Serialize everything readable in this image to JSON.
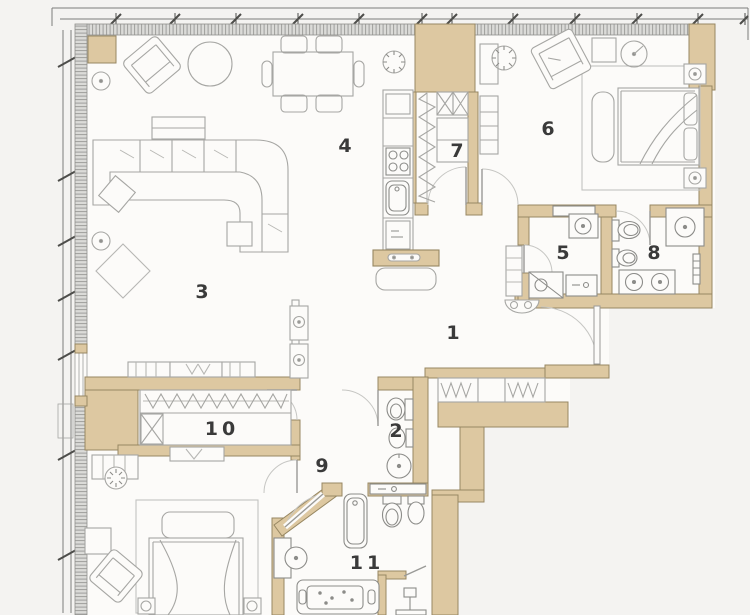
{
  "plan": {
    "rooms": [
      {
        "number": "1"
      },
      {
        "number": "2"
      },
      {
        "number": "3"
      },
      {
        "number": "4"
      },
      {
        "number": "5"
      },
      {
        "number": "6"
      },
      {
        "number": "7"
      },
      {
        "number": "8"
      },
      {
        "number": "9"
      },
      {
        "number": "10"
      },
      {
        "number": "11"
      }
    ],
    "colors": {
      "wall_fill": "#ddc8a1",
      "wall_stroke": "#978762",
      "glazing_bg": "#dbdbd8",
      "glazing_line": "#9e9e9b",
      "furniture_line": "#a6a6a3",
      "fixture_line": "#8c8c89",
      "door_arc": "#c6c6c3",
      "label_color": "#3a3a3a",
      "background": "#f4f3f1",
      "floor_fill": "#fcfbf9"
    }
  }
}
